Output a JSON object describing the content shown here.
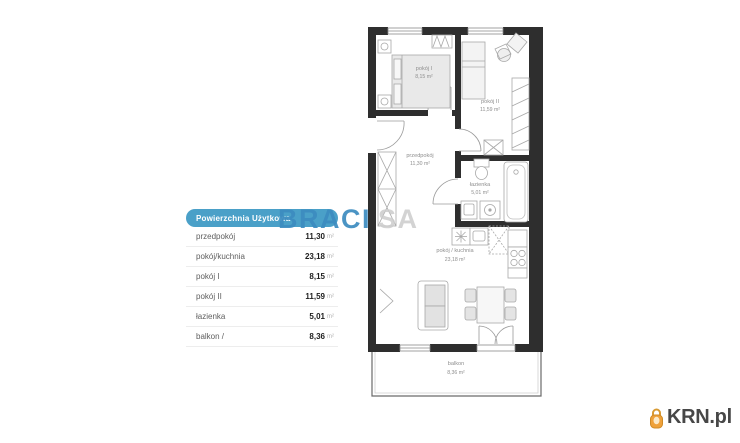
{
  "table": {
    "header": "Powierzchnia Użytkowa",
    "rows": [
      {
        "label": "przedpokój",
        "value": "11,30",
        "unit": "m²"
      },
      {
        "label": "pokój/kuchnia",
        "value": "23,18",
        "unit": "m²"
      },
      {
        "label": "pokój I",
        "value": "8,15",
        "unit": "m²"
      },
      {
        "label": "pokój II",
        "value": "11,59",
        "unit": "m²"
      },
      {
        "label": "łazienka",
        "value": "5,01",
        "unit": "m²"
      },
      {
        "label": "balkon /",
        "value": "8,36",
        "unit": "m²"
      }
    ]
  },
  "watermark": {
    "primary": "BRACI",
    "secondary": "SA"
  },
  "floorplan": {
    "rooms": [
      {
        "name": "pokój I",
        "area": "8,15 m²"
      },
      {
        "name": "pokój II",
        "area": "11,59 m²"
      },
      {
        "name": "przedpokój",
        "area": "11,30 m²"
      },
      {
        "name": "łazienka",
        "area": "5,01 m²"
      },
      {
        "name": "pokój / kuchnia",
        "area": "23,18 m²"
      },
      {
        "name": "balkon",
        "area": "8,36 m²"
      }
    ]
  },
  "logo": {
    "text": "KRN.pl"
  },
  "colors": {
    "header_pill": "#4aa0c8",
    "watermark_blue": "#3c8cc0",
    "wall": "#2e2e2e",
    "logo_icon_orange": "#efa13a"
  }
}
